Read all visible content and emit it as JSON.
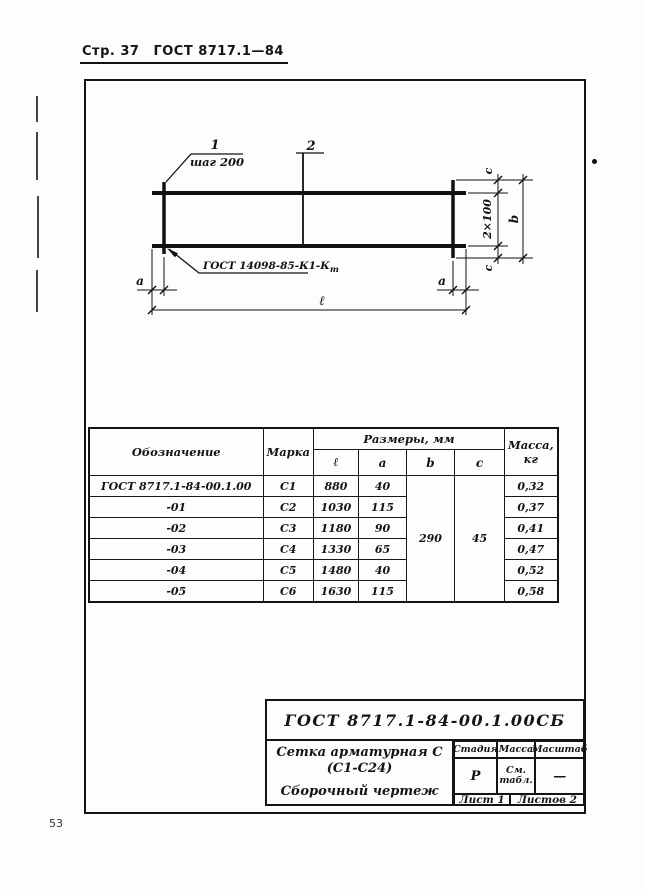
{
  "page": {
    "header_page": "Стр. 37",
    "header_gost": "ГОСТ 8717.1—84",
    "page_number": "53"
  },
  "drawing": {
    "callout_1": "1",
    "callout_1_note": "шаг 200",
    "callout_2": "2",
    "weld_note": "ГОСТ 14098-85-К1-К",
    "weld_note_subscript": "т",
    "dim_a_left": "a",
    "dim_a_right": "a",
    "dim_l": "ℓ",
    "dim_c_top": "c",
    "dim_c_bottom": "c",
    "dim_span": "2×100",
    "dim_b": "b"
  },
  "table": {
    "col_designation": "Обозначение",
    "col_mark": "Марка",
    "col_dims": "Размеры, мм",
    "col_mass_line1": "Масса,",
    "col_mass_line2": "кг",
    "sub_cols": [
      "ℓ",
      "a",
      "b",
      "c"
    ],
    "merged_b": "290",
    "merged_c": "45",
    "rows": [
      {
        "designation": "ГОСТ 8717.1-84-00.1.00",
        "mark": "С1",
        "l": "880",
        "a": "40",
        "mass": "0,32"
      },
      {
        "designation": "-01",
        "mark": "С2",
        "l": "1030",
        "a": "115",
        "mass": "0,37"
      },
      {
        "designation": "-02",
        "mark": "С3",
        "l": "1180",
        "a": "90",
        "mass": "0,41"
      },
      {
        "designation": "-03",
        "mark": "С4",
        "l": "1330",
        "a": "65",
        "mass": "0,47"
      },
      {
        "designation": "-04",
        "mark": "С5",
        "l": "1480",
        "a": "40",
        "mass": "0,52"
      },
      {
        "designation": "-05",
        "mark": "С6",
        "l": "1630",
        "a": "115",
        "mass": "0,58"
      }
    ]
  },
  "title_block": {
    "doc_number": "ГОСТ 8717.1-84-00.1.00СБ",
    "name_line1": "Сетка арматурная С",
    "name_line2": "(С1-С24)",
    "name_line3": "Сборочный чертеж",
    "stage_label": "Стадия",
    "mass_label": "Масса",
    "scale_label": "Масштаб",
    "stage_value": "Р",
    "mass_value_line1": "См.",
    "mass_value_line2": "табл.",
    "scale_value": "—",
    "sheet_label": "Лист 1",
    "sheets_label": "Листов 2"
  }
}
